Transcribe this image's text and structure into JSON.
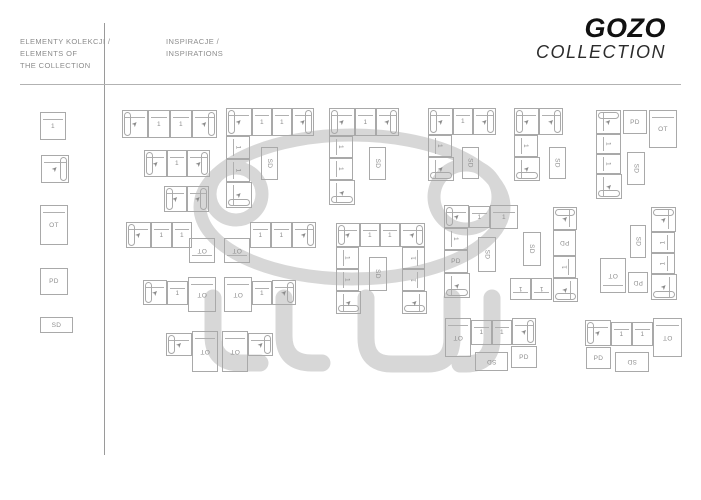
{
  "brand": {
    "name": "GOZO",
    "sub": "COLLECTION"
  },
  "sidebar": {
    "title_lines": [
      "ELEMENTY KOLEKCJI /",
      "ELEMENTS OF",
      "THE COLLECTION"
    ],
    "elements": [
      {
        "x": 40,
        "y": 112,
        "w": 26,
        "h": 28,
        "t": "seat",
        "bk": "t"
      },
      {
        "x": 41,
        "y": 155,
        "w": 28,
        "h": 28,
        "t": "arm",
        "a": "r",
        "bk": "t"
      },
      {
        "x": 40,
        "y": 205,
        "w": 28,
        "h": 40,
        "t": "ot",
        "bk": "t"
      },
      {
        "x": 40,
        "y": 268,
        "w": 28,
        "h": 27,
        "t": "pd"
      },
      {
        "x": 40,
        "y": 317,
        "w": 33,
        "h": 16,
        "t": "sd"
      }
    ]
  },
  "main": {
    "title_lines": [
      "INSPIRACJE /",
      "INSPIRATIONS"
    ]
  },
  "module_labels": {
    "seat": "1",
    "ot": "OT",
    "pd": "PD",
    "sd": "SD"
  },
  "icons": {
    "arrow": "➤"
  },
  "colors": {
    "line": "#a9a9a9",
    "label": "#8f8f8f",
    "watermark": "#d7d7d7",
    "brand_text": "#111111"
  },
  "configurations": [
    {
      "name": "sofa-4-seats",
      "modules": [
        {
          "x": 122,
          "y": 110,
          "w": 26,
          "h": 28,
          "t": "arm",
          "a": "l",
          "bk": "t"
        },
        {
          "x": 148,
          "y": 110,
          "w": 22,
          "h": 28,
          "t": "seat",
          "bk": "t"
        },
        {
          "x": 170,
          "y": 110,
          "w": 22,
          "h": 28,
          "t": "seat",
          "bk": "t"
        },
        {
          "x": 192,
          "y": 110,
          "w": 25,
          "h": 28,
          "t": "arm",
          "a": "r",
          "bk": "t"
        }
      ]
    },
    {
      "name": "sofa-3-seats",
      "modules": [
        {
          "x": 144,
          "y": 150,
          "w": 23,
          "h": 27,
          "t": "arm",
          "a": "l",
          "bk": "t"
        },
        {
          "x": 167,
          "y": 150,
          "w": 20,
          "h": 27,
          "t": "seat",
          "bk": "t"
        },
        {
          "x": 187,
          "y": 150,
          "w": 23,
          "h": 27,
          "t": "arm",
          "a": "r",
          "bk": "t"
        }
      ]
    },
    {
      "name": "sofa-2-seats",
      "modules": [
        {
          "x": 164,
          "y": 186,
          "w": 23,
          "h": 26,
          "t": "arm",
          "a": "l",
          "bk": "t"
        },
        {
          "x": 187,
          "y": 186,
          "w": 22,
          "h": 26,
          "t": "arm",
          "a": "r",
          "bk": "t"
        }
      ]
    },
    {
      "name": "corner-4-wide",
      "modules": [
        {
          "x": 226,
          "y": 108,
          "w": 26,
          "h": 28,
          "t": "arm",
          "a": "l",
          "bk": "t"
        },
        {
          "x": 252,
          "y": 108,
          "w": 20,
          "h": 28,
          "t": "seat",
          "bk": "t"
        },
        {
          "x": 272,
          "y": 108,
          "w": 20,
          "h": 28,
          "t": "seat",
          "bk": "t"
        },
        {
          "x": 292,
          "y": 108,
          "w": 22,
          "h": 28,
          "t": "arm",
          "a": "r",
          "bk": "t"
        },
        {
          "x": 226,
          "y": 136,
          "w": 24,
          "h": 23,
          "t": "seat",
          "r": 90,
          "bk": "l"
        },
        {
          "x": 226,
          "y": 159,
          "w": 24,
          "h": 23,
          "t": "seat",
          "r": 90,
          "bk": "l"
        },
        {
          "x": 226,
          "y": 182,
          "w": 26,
          "h": 26,
          "t": "arm",
          "a": "b",
          "bk": "l"
        },
        {
          "x": 261,
          "y": 147,
          "w": 17,
          "h": 33,
          "t": "sd",
          "r": 90
        }
      ]
    },
    {
      "name": "corner-3-wide",
      "modules": [
        {
          "x": 329,
          "y": 108,
          "w": 26,
          "h": 28,
          "t": "arm",
          "a": "l",
          "bk": "t"
        },
        {
          "x": 355,
          "y": 108,
          "w": 21,
          "h": 28,
          "t": "seat",
          "bk": "t"
        },
        {
          "x": 376,
          "y": 108,
          "w": 23,
          "h": 28,
          "t": "arm",
          "a": "r",
          "bk": "t"
        },
        {
          "x": 329,
          "y": 136,
          "w": 24,
          "h": 22,
          "t": "seat",
          "r": 90,
          "bk": "l"
        },
        {
          "x": 329,
          "y": 158,
          "w": 24,
          "h": 22,
          "t": "seat",
          "r": 90,
          "bk": "l"
        },
        {
          "x": 329,
          "y": 180,
          "w": 26,
          "h": 25,
          "t": "arm",
          "a": "b",
          "bk": "l"
        },
        {
          "x": 369,
          "y": 147,
          "w": 17,
          "h": 33,
          "t": "sd",
          "r": 90
        }
      ]
    },
    {
      "name": "corner-3-wide-short",
      "modules": [
        {
          "x": 428,
          "y": 108,
          "w": 25,
          "h": 27,
          "t": "arm",
          "a": "l",
          "bk": "t"
        },
        {
          "x": 453,
          "y": 108,
          "w": 20,
          "h": 27,
          "t": "seat",
          "bk": "t"
        },
        {
          "x": 473,
          "y": 108,
          "w": 23,
          "h": 27,
          "t": "arm",
          "a": "r",
          "bk": "t"
        },
        {
          "x": 428,
          "y": 135,
          "w": 24,
          "h": 22,
          "t": "seat",
          "r": 90,
          "bk": "l"
        },
        {
          "x": 428,
          "y": 157,
          "w": 26,
          "h": 24,
          "t": "arm",
          "a": "b",
          "bk": "l"
        },
        {
          "x": 462,
          "y": 147,
          "w": 17,
          "h": 32,
          "t": "sd",
          "r": 90
        }
      ]
    },
    {
      "name": "corner-2-wide",
      "modules": [
        {
          "x": 514,
          "y": 108,
          "w": 25,
          "h": 27,
          "t": "arm",
          "a": "l",
          "bk": "t"
        },
        {
          "x": 539,
          "y": 108,
          "w": 24,
          "h": 27,
          "t": "arm",
          "a": "r",
          "bk": "t"
        },
        {
          "x": 514,
          "y": 135,
          "w": 24,
          "h": 22,
          "t": "seat",
          "r": 90,
          "bk": "l"
        },
        {
          "x": 514,
          "y": 157,
          "w": 26,
          "h": 24,
          "t": "arm",
          "a": "b",
          "bk": "l"
        },
        {
          "x": 549,
          "y": 147,
          "w": 17,
          "h": 32,
          "t": "sd",
          "r": 90
        }
      ]
    },
    {
      "name": "column-with-pd-ot",
      "modules": [
        {
          "x": 596,
          "y": 110,
          "w": 25,
          "h": 24,
          "t": "arm",
          "a": "t",
          "bk": "l"
        },
        {
          "x": 596,
          "y": 134,
          "w": 25,
          "h": 20,
          "t": "seat",
          "r": 90,
          "bk": "l"
        },
        {
          "x": 596,
          "y": 154,
          "w": 25,
          "h": 20,
          "t": "seat",
          "r": 90,
          "bk": "l"
        },
        {
          "x": 596,
          "y": 174,
          "w": 26,
          "h": 25,
          "t": "arm",
          "a": "b",
          "bk": "l"
        },
        {
          "x": 623,
          "y": 110,
          "w": 24,
          "h": 24,
          "t": "pd"
        },
        {
          "x": 649,
          "y": 110,
          "w": 28,
          "h": 38,
          "t": "ot",
          "bk": "t"
        },
        {
          "x": 627,
          "y": 152,
          "w": 18,
          "h": 33,
          "t": "sd",
          "r": 90
        }
      ]
    },
    {
      "name": "sofa-with-ottoman-right",
      "modules": [
        {
          "x": 126,
          "y": 222,
          "w": 25,
          "h": 26,
          "t": "arm",
          "a": "l",
          "bk": "t"
        },
        {
          "x": 151,
          "y": 222,
          "w": 21,
          "h": 26,
          "t": "seat",
          "bk": "t"
        },
        {
          "x": 172,
          "y": 222,
          "w": 20,
          "h": 26,
          "t": "seat",
          "bk": "t"
        },
        {
          "x": 189,
          "y": 238,
          "w": 26,
          "h": 25,
          "t": "ot",
          "r": 180,
          "bk": "b"
        }
      ]
    },
    {
      "name": "sofa-with-ottoman-left",
      "modules": [
        {
          "x": 224,
          "y": 238,
          "w": 26,
          "h": 25,
          "t": "ot",
          "r": 180,
          "bk": "b"
        },
        {
          "x": 250,
          "y": 222,
          "w": 21,
          "h": 26,
          "t": "seat",
          "bk": "t"
        },
        {
          "x": 271,
          "y": 222,
          "w": 21,
          "h": 26,
          "t": "seat",
          "bk": "t"
        },
        {
          "x": 292,
          "y": 222,
          "w": 24,
          "h": 26,
          "t": "arm",
          "a": "r",
          "bk": "t"
        }
      ]
    },
    {
      "name": "u-shape",
      "modules": [
        {
          "x": 336,
          "y": 223,
          "w": 24,
          "h": 24,
          "t": "arm",
          "a": "l",
          "bk": "t"
        },
        {
          "x": 360,
          "y": 223,
          "w": 20,
          "h": 24,
          "t": "seat",
          "bk": "t"
        },
        {
          "x": 380,
          "y": 223,
          "w": 20,
          "h": 24,
          "t": "seat",
          "bk": "t"
        },
        {
          "x": 400,
          "y": 223,
          "w": 25,
          "h": 24,
          "t": "arm",
          "a": "r",
          "bk": "t"
        },
        {
          "x": 336,
          "y": 247,
          "w": 23,
          "h": 22,
          "t": "seat",
          "r": 90,
          "bk": "l"
        },
        {
          "x": 336,
          "y": 269,
          "w": 23,
          "h": 22,
          "t": "seat",
          "r": 90,
          "bk": "l"
        },
        {
          "x": 336,
          "y": 291,
          "w": 25,
          "h": 23,
          "t": "arm",
          "a": "b",
          "bk": "l"
        },
        {
          "x": 402,
          "y": 247,
          "w": 23,
          "h": 22,
          "t": "seat",
          "r": 270,
          "bk": "r"
        },
        {
          "x": 402,
          "y": 269,
          "w": 23,
          "h": 22,
          "t": "seat",
          "r": 270,
          "bk": "r"
        },
        {
          "x": 402,
          "y": 291,
          "w": 25,
          "h": 23,
          "t": "arm",
          "a": "b",
          "bk": "r"
        },
        {
          "x": 369,
          "y": 257,
          "w": 18,
          "h": 34,
          "t": "sd",
          "r": 90
        }
      ]
    },
    {
      "name": "corner-with-pd-column",
      "modules": [
        {
          "x": 444,
          "y": 205,
          "w": 25,
          "h": 23,
          "t": "arm",
          "a": "l",
          "bk": "t"
        },
        {
          "x": 469,
          "y": 206,
          "w": 21,
          "h": 22,
          "t": "seat",
          "bk": "t"
        },
        {
          "x": 490,
          "y": 205,
          "w": 28,
          "h": 24,
          "t": "seat",
          "bk": "t"
        },
        {
          "x": 444,
          "y": 228,
          "w": 24,
          "h": 22,
          "t": "seat",
          "r": 90,
          "bk": "l"
        },
        {
          "x": 444,
          "y": 250,
          "w": 24,
          "h": 23,
          "t": "pd"
        },
        {
          "x": 444,
          "y": 273,
          "w": 26,
          "h": 25,
          "t": "arm",
          "a": "b",
          "bk": "l"
        },
        {
          "x": 478,
          "y": 237,
          "w": 18,
          "h": 35,
          "t": "sd",
          "r": 90
        }
      ]
    },
    {
      "name": "corner-with-pd-column-mirror",
      "modules": [
        {
          "x": 553,
          "y": 207,
          "w": 24,
          "h": 23,
          "t": "arm",
          "a": "t",
          "bk": "r"
        },
        {
          "x": 553,
          "y": 230,
          "w": 23,
          "h": 26,
          "t": "pd",
          "r": 180
        },
        {
          "x": 553,
          "y": 256,
          "w": 23,
          "h": 22,
          "t": "seat",
          "r": 270,
          "bk": "r"
        },
        {
          "x": 553,
          "y": 278,
          "w": 25,
          "h": 24,
          "t": "arm",
          "a": "b",
          "bk": "r"
        },
        {
          "x": 510,
          "y": 278,
          "w": 21,
          "h": 22,
          "t": "seat",
          "r": 180,
          "bk": "b"
        },
        {
          "x": 531,
          "y": 278,
          "w": 21,
          "h": 22,
          "t": "seat",
          "r": 180,
          "bk": "b"
        },
        {
          "x": 523,
          "y": 232,
          "w": 18,
          "h": 34,
          "t": "sd",
          "r": 90
        }
      ]
    },
    {
      "name": "column-with-ot-pd",
      "modules": [
        {
          "x": 600,
          "y": 258,
          "w": 26,
          "h": 35,
          "t": "ot",
          "r": 180,
          "bk": "b"
        },
        {
          "x": 628,
          "y": 272,
          "w": 20,
          "h": 21,
          "t": "pd",
          "r": 180
        },
        {
          "x": 651,
          "y": 207,
          "w": 25,
          "h": 25,
          "t": "arm",
          "a": "t",
          "bk": "r"
        },
        {
          "x": 651,
          "y": 232,
          "w": 24,
          "h": 21,
          "t": "seat",
          "r": 270,
          "bk": "r"
        },
        {
          "x": 651,
          "y": 253,
          "w": 24,
          "h": 21,
          "t": "seat",
          "r": 270,
          "bk": "r"
        },
        {
          "x": 651,
          "y": 274,
          "w": 26,
          "h": 26,
          "t": "arm",
          "a": "b",
          "bk": "r"
        },
        {
          "x": 630,
          "y": 225,
          "w": 16,
          "h": 33,
          "t": "sd",
          "r": 90
        }
      ]
    },
    {
      "name": "chaise-2-right",
      "modules": [
        {
          "x": 143,
          "y": 280,
          "w": 24,
          "h": 25,
          "t": "arm",
          "a": "l",
          "bk": "t"
        },
        {
          "x": 167,
          "y": 281,
          "w": 21,
          "h": 24,
          "t": "seat",
          "bk": "t"
        },
        {
          "x": 188,
          "y": 277,
          "w": 28,
          "h": 35,
          "t": "ot",
          "r": 180,
          "bk": "t"
        }
      ]
    },
    {
      "name": "chaise-2-left",
      "modules": [
        {
          "x": 224,
          "y": 277,
          "w": 28,
          "h": 35,
          "t": "ot",
          "r": 180,
          "bk": "t"
        },
        {
          "x": 252,
          "y": 281,
          "w": 20,
          "h": 24,
          "t": "seat",
          "bk": "t"
        },
        {
          "x": 272,
          "y": 280,
          "w": 24,
          "h": 25,
          "t": "arm",
          "a": "r",
          "bk": "t"
        }
      ]
    },
    {
      "name": "chaise-1-right",
      "modules": [
        {
          "x": 166,
          "y": 333,
          "w": 26,
          "h": 23,
          "t": "arm",
          "a": "l",
          "bk": "t"
        },
        {
          "x": 192,
          "y": 331,
          "w": 26,
          "h": 41,
          "t": "ot",
          "r": 180,
          "bk": "t"
        }
      ]
    },
    {
      "name": "chaise-1-left",
      "modules": [
        {
          "x": 222,
          "y": 331,
          "w": 26,
          "h": 41,
          "t": "ot",
          "r": 180,
          "bk": "t"
        },
        {
          "x": 248,
          "y": 333,
          "w": 25,
          "h": 23,
          "t": "arm",
          "a": "r",
          "bk": "t"
        }
      ]
    },
    {
      "name": "chaise-sofa-sd-pd-right",
      "modules": [
        {
          "x": 445,
          "y": 318,
          "w": 26,
          "h": 39,
          "t": "ot",
          "r": 180,
          "bk": "t"
        },
        {
          "x": 471,
          "y": 320,
          "w": 21,
          "h": 25,
          "t": "seat",
          "bk": "t"
        },
        {
          "x": 492,
          "y": 320,
          "w": 20,
          "h": 25,
          "t": "seat",
          "bk": "t"
        },
        {
          "x": 512,
          "y": 318,
          "w": 24,
          "h": 27,
          "t": "arm",
          "a": "r",
          "bk": "t"
        },
        {
          "x": 475,
          "y": 352,
          "w": 33,
          "h": 19,
          "t": "sd",
          "r": 180
        },
        {
          "x": 511,
          "y": 346,
          "w": 26,
          "h": 22,
          "t": "pd"
        }
      ]
    },
    {
      "name": "chaise-sofa-sd-pd-left",
      "modules": [
        {
          "x": 585,
          "y": 320,
          "w": 26,
          "h": 26,
          "t": "arm",
          "a": "l",
          "bk": "t"
        },
        {
          "x": 611,
          "y": 322,
          "w": 21,
          "h": 24,
          "t": "seat",
          "bk": "t"
        },
        {
          "x": 632,
          "y": 322,
          "w": 21,
          "h": 24,
          "t": "seat",
          "bk": "t"
        },
        {
          "x": 653,
          "y": 318,
          "w": 29,
          "h": 39,
          "t": "ot",
          "r": 180,
          "bk": "t"
        },
        {
          "x": 586,
          "y": 347,
          "w": 25,
          "h": 22,
          "t": "pd"
        },
        {
          "x": 615,
          "y": 352,
          "w": 34,
          "h": 20,
          "t": "sd",
          "r": 180
        }
      ]
    }
  ]
}
